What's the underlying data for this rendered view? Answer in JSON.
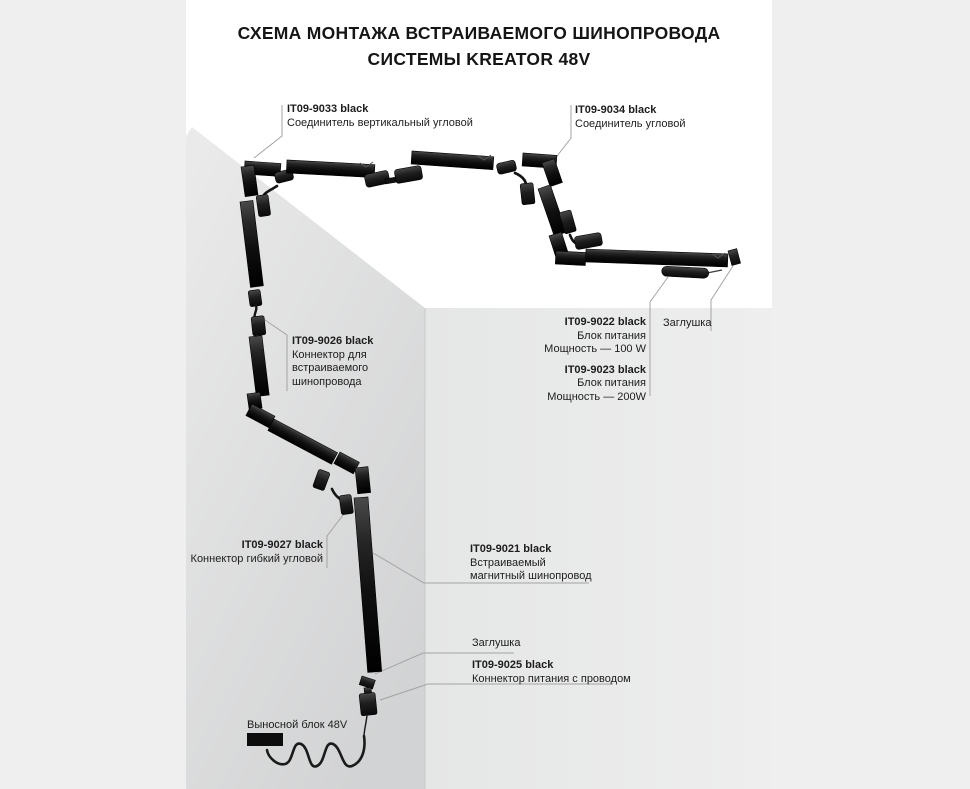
{
  "title": {
    "line1": "СХЕМА МОНТАЖА ВСТРАИВАЕМОГО ШИНОПРОВОДА",
    "line2": "СИСТЕМЫ KREATOR 48V"
  },
  "labels": {
    "c9033": {
      "code": "IT09-9033 black",
      "desc": "Соединитель вертикальный угловой"
    },
    "c9034": {
      "code": "IT09-9034 black",
      "desc": "Соединитель угловой"
    },
    "c9026": {
      "code": "IT09-9026 black",
      "desc1": "Коннектор для",
      "desc2": "встраиваемого",
      "desc3": "шинопровода"
    },
    "psu100": {
      "code": "IT09-9022 black",
      "desc1": "Блок питания",
      "desc2": "Мощность — 100 W"
    },
    "psu200": {
      "code": "IT09-9023 black",
      "desc1": "Блок питания",
      "desc2": "Мощность — 200W"
    },
    "plug_top": {
      "text": "Заглушка"
    },
    "c9027": {
      "code": "IT09-9027 black",
      "desc": "Коннектор гибкий угловой"
    },
    "track9021": {
      "code": "IT09-9021 black",
      "desc1": "Встраиваемый",
      "desc2": "магнитный шинопровод"
    },
    "plug_bottom": {
      "text": "Заглушка"
    },
    "c9025": {
      "code": "IT09-9025 black",
      "desc": "Коннектор питания с проводом"
    },
    "remote": {
      "text": "Выносной блок 48V"
    }
  },
  "colors": {
    "background": "#efefef",
    "panel": "#ffffff",
    "wall_left_top": "#ebebeb",
    "wall_left_bottom": "#d2d3d4",
    "wall_right_left": "#e5e6e6",
    "wall_right_right": "#eeeeee",
    "track_black": "#161616",
    "leader_line": "#a3a3a3",
    "text": "#1d1d1d"
  }
}
